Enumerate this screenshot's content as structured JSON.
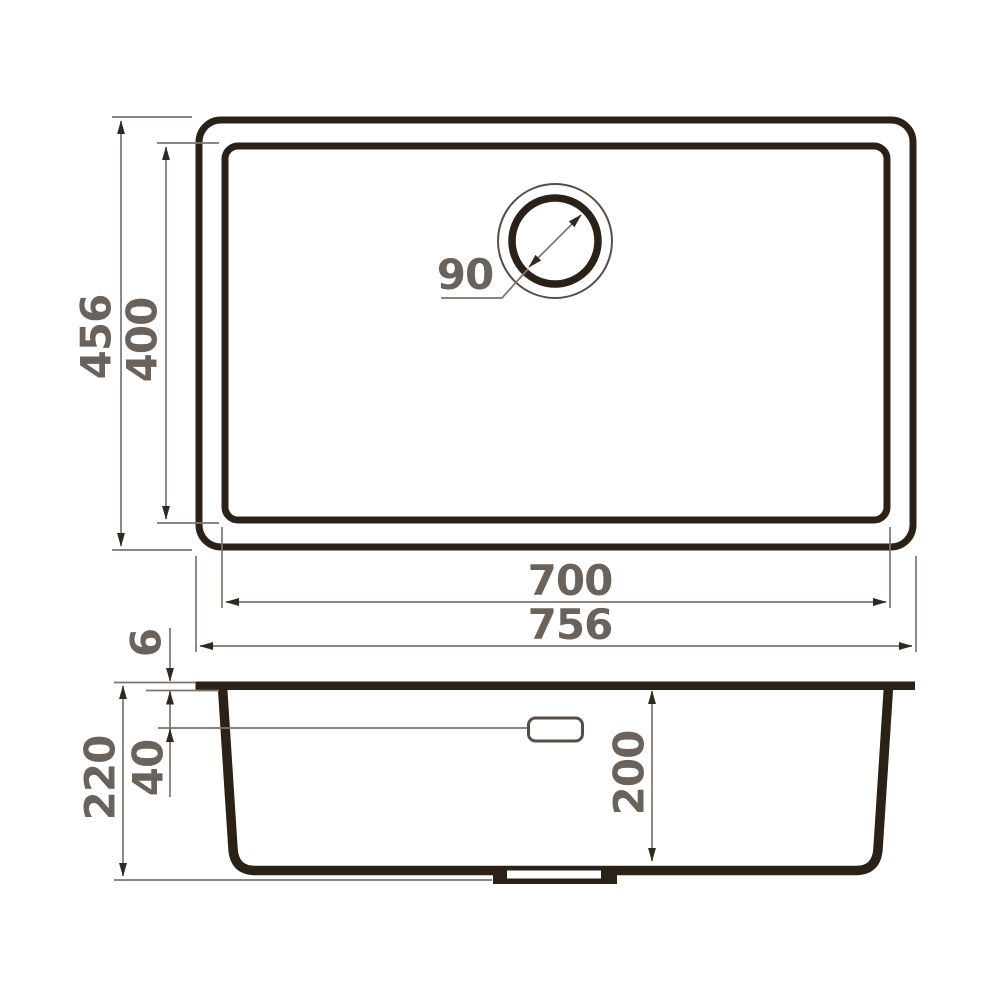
{
  "drawing": {
    "subject": "kitchen sink technical drawing with top view and side section view",
    "colors": {
      "outline": "#2b2117",
      "dim_line": "#7c746c",
      "arrow": "#32281f",
      "label": "#6b635b",
      "background": "#ffffff"
    },
    "top_view": {
      "labels": {
        "overall_length": "756",
        "bowl_length": "700",
        "overall_width": "456",
        "bowl_width": "400",
        "drain_diameter": "90"
      }
    },
    "side_view": {
      "labels": {
        "total_height": "220",
        "bowl_depth": "200",
        "rim_thickness": "6",
        "overflow_offset": "40"
      }
    }
  }
}
